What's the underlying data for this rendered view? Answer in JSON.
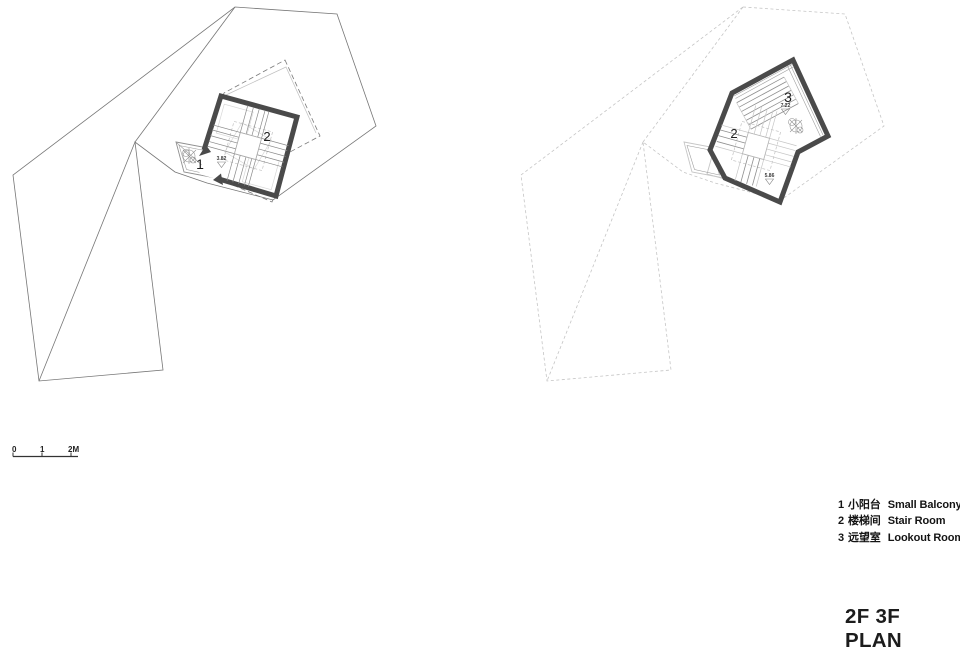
{
  "title": "2F 3F PLAN",
  "legend": {
    "items": [
      {
        "num": "1",
        "cn": "小阳台",
        "en": "Small Balcony"
      },
      {
        "num": "2",
        "cn": "楼梯间",
        "en": "Stair Room"
      },
      {
        "num": "3",
        "cn": "远望室",
        "en": "Lookout Room"
      }
    ]
  },
  "scale_bar": {
    "t0": "0",
    "t1": "1",
    "t2": "2M"
  },
  "plans": {
    "left": {
      "balcony_label": "1",
      "stair_label": "2",
      "level": "3.82"
    },
    "right": {
      "stair_label": "2",
      "lookout_label": "3",
      "level_upper": "7.22",
      "level_mid": "5.86"
    }
  },
  "colors": {
    "wall": "#4a4a4a",
    "line": "#767676",
    "faint": "#c5c5c5"
  }
}
